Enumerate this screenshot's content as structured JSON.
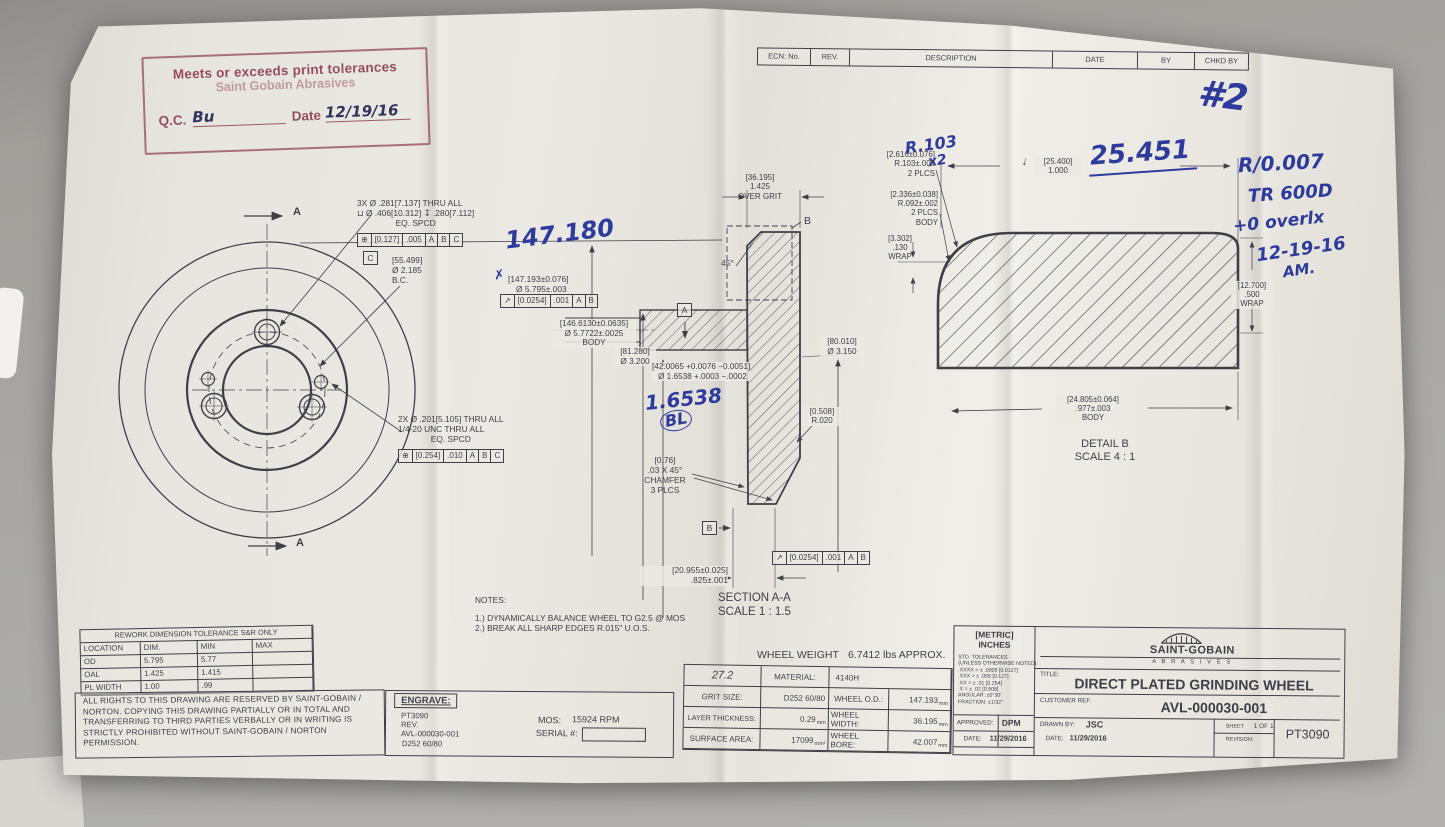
{
  "colors": {
    "paper": "#e9e7e1",
    "ink": "#3f3f48",
    "stamp_red": "#8f4150",
    "pen_blue": "#2d3b9d",
    "background": "#a2a19d"
  },
  "stamp": {
    "line1": "Meets or exceeds print tolerances",
    "line2": "Saint Gobain Abrasives",
    "qc_label": "Q.C.",
    "qc_signature": "Bu",
    "date_label": "Date",
    "date_value": "12/19/16"
  },
  "ecn": {
    "headers": [
      "ECN: No.",
      "REV.",
      "DESCRIPTION",
      "DATE",
      "BY",
      "CHKD BY"
    ]
  },
  "pen": {
    "page_mark": "#2",
    "note1": "R/0.007",
    "note2": "TR 600D",
    "note3": "+0 overlx",
    "note4": "12-19-16",
    "note5": "AM.",
    "od_dim": "147.180",
    "od_check": "✗",
    "bore_dim": "1.6538",
    "bore_initials": "BL",
    "radius_note": "R.103",
    "radius_mult": "x2",
    "width_dim": "25.451",
    "depth_mark": "↓"
  },
  "front": {
    "section_label_top": "A",
    "section_label_bottom": "A",
    "cbore_l1": "3X Ø .281[7.137] THRU ALL",
    "cbore_l2": "⊔ Ø .406[10.312]  ↧ .280[7.112]",
    "cbore_l3": "EQ. SPCD",
    "cbore_fcf": [
      "⊕",
      "[0.127]",
      ".005",
      "A",
      "B",
      "C"
    ],
    "datum_c": "C",
    "bc_l1": "[55.499]",
    "bc_l2": "Ø 2.185",
    "bc_l3": "B.C.",
    "tap_l1": "2X Ø .201[5.105] THRU ALL",
    "tap_l2": "1/4-20 UNC  THRU ALL",
    "tap_l3": "EQ. SPCD",
    "tap_fcf": [
      "⊕",
      "[0.254]",
      ".010",
      "A",
      "B",
      "C"
    ]
  },
  "section": {
    "overgrit_l1": "[36.195]",
    "overgrit_l2": "1.425",
    "overgrit_l3": "OVER GRIT",
    "detail_tag": "B",
    "angle": "45°",
    "od_l1": "[147.193±0.076]",
    "od_l2": "Ø 5.795±.003",
    "od_fcf": [
      "↗",
      "[0.0254]",
      ".001",
      "A",
      "B"
    ],
    "body_l1": "[146.6130±0.0635]",
    "body_l2": "Ø 5.7722±.0025",
    "body_l3": "BODY",
    "hub_l1": "[81.280]",
    "hub_l2": "Ø 3.200",
    "bore_l1": "[42.0065 +0.0076 −0.0051]",
    "bore_l2": "Ø 1.6538 +.0003 −.0002",
    "datum_a": "A",
    "od2_l1": "[80.010]",
    "od2_l2": "Ø 3.150",
    "rad_l1": "[0.508]",
    "rad_l2": "R.020",
    "cham_l1": "[0.76]",
    "cham_l2": ".03  X 45°",
    "cham_l3": "CHAMFER",
    "cham_l4": "3 PLCS",
    "datum_b": "B",
    "par_fcf": [
      "↗",
      "[0.0254]",
      ".001",
      "A",
      "B"
    ],
    "width_l1": "[20.955±0.025]",
    "width_l2": ".825±.001",
    "label": "SECTION A-A",
    "scale": "SCALE 1 : 1.5"
  },
  "detail": {
    "corner_l1": "[2.616±0.076]",
    "corner_l2": "R.103±.003",
    "corner_l3": "2 PLCS",
    "width_l1": "[25.400]",
    "width_l2": "1.000",
    "bodyrad_l1": "[2.336±0.038]",
    "bodyrad_l2": "R.092±.002",
    "bodyrad_l3": "2 PLCS",
    "bodyrad_l4": "BODY",
    "wrap_l1": "[3.302]",
    "wrap_l2": ".130",
    "wrap_l3": "WRAP",
    "wrap2_l1": "[12.700]",
    "wrap2_l2": ".500",
    "wrap2_l3": "WRAP",
    "bodyw_l1": "[24.805±0.064]",
    "bodyw_l2": ".977±.003",
    "bodyw_l3": "BODY",
    "label": "DETAIL B",
    "scale": "SCALE 4 : 1"
  },
  "notes": {
    "header": "NOTES:",
    "item1": "1.) DYNAMICALLY BALANCE WHEEL TO G2.5 @ MOS",
    "item2": "2.) BREAK ALL SHARP EDGES R.015\" U.O.S."
  },
  "weight": {
    "label": "WHEEL WEIGHT",
    "value": "6.7412 lbs APPROX."
  },
  "rework": {
    "title": "REWORK DIMENSION TOLERANCE S&R ONLY",
    "headers": [
      "LOCATION",
      "DIM.",
      "MIN",
      "MAX"
    ],
    "rows": [
      [
        "OD",
        "5.795",
        "5.77",
        ""
      ],
      [
        "OAL",
        "1.425",
        "1.415",
        ""
      ],
      [
        "PL WIDTH",
        "1.00",
        ".99",
        ""
      ]
    ]
  },
  "legal": {
    "text": "ALL RIGHTS TO THIS DRAWING ARE RESERVED BY SAINT-GOBAIN / NORTON. COPYING THIS DRAWING PARTIALLY OR IN TOTAL AND TRANSFERRING TO THIRD PARTIES VERBALLY OR IN WRITING IS STRICTLY PROHIBITED WITHOUT SAINT-GOBAIN / NORTON PERMISSION."
  },
  "engrave": {
    "header": "ENGRAVE:",
    "line1": "PT3090",
    "line2": "REV.",
    "line3": "AVL-000030-001",
    "line4": "D252 60/80",
    "mos_label": "MOS:",
    "mos_value": "15924 RPM",
    "serial_label": "SERIAL #:"
  },
  "spec": {
    "hand_value": "27.2",
    "material_label": "MATERIAL:",
    "material_value": "4140H",
    "rows": [
      {
        "l": "GRIT SIZE:",
        "v": "D252 60/80",
        "u": "",
        "l2": "WHEEL O.D.:",
        "v2": "147.193",
        "u2": "mm"
      },
      {
        "l": "LAYER THICKNESS:",
        "v": "0.29",
        "u": "mm",
        "l2": "WHEEL WIDTH:",
        "v2": "36.195",
        "u2": "mm"
      },
      {
        "l": "SURFACE AREA:",
        "v": "17099",
        "u": "mm²",
        "l2": "WHEEL BORE:",
        "v2": "42.007",
        "u2": "mm"
      }
    ]
  },
  "tblock": {
    "units1": "[METRIC]",
    "units2": "INCHES",
    "tol_title": "STD. TOLERANCES",
    "tol_note": "(UNLESS OTHERWISE NOTED):",
    "tol1": ".XXXX = ± .0005 [0.0127]",
    "tol2": ".XXX = ± .005 [0.127]",
    "tol3": ".XX = ± .01 [0.254]",
    "tol4": ".X = ± .02 [0.508]",
    "tol5": "ANGULAR:  ±0°30'",
    "tol6": "FRACTION:  ±1/32\"",
    "approved_label": "APPROVED:",
    "approved_value": "DPM",
    "date_label": "DATE:",
    "approved_date": "11/29/2016",
    "brand": "SAINT-GOBAIN",
    "brand_sub": "A B R A S I V E S",
    "title_label": "TITLE:",
    "title": "DIRECT PLATED GRINDING WHEEL",
    "customer_label": "CUSTOMER REF.",
    "part_number": "AVL-000030-001",
    "drawn_label": "DRAWN BY:",
    "drawn_value": "JSC",
    "drawn_date_label": "DATE:",
    "drawn_date": "11/29/2016",
    "sheet_label": "SHEET",
    "sheet_value": "1 OF 1",
    "revision_label": "REVISION:",
    "doc_number": "PT3090"
  }
}
